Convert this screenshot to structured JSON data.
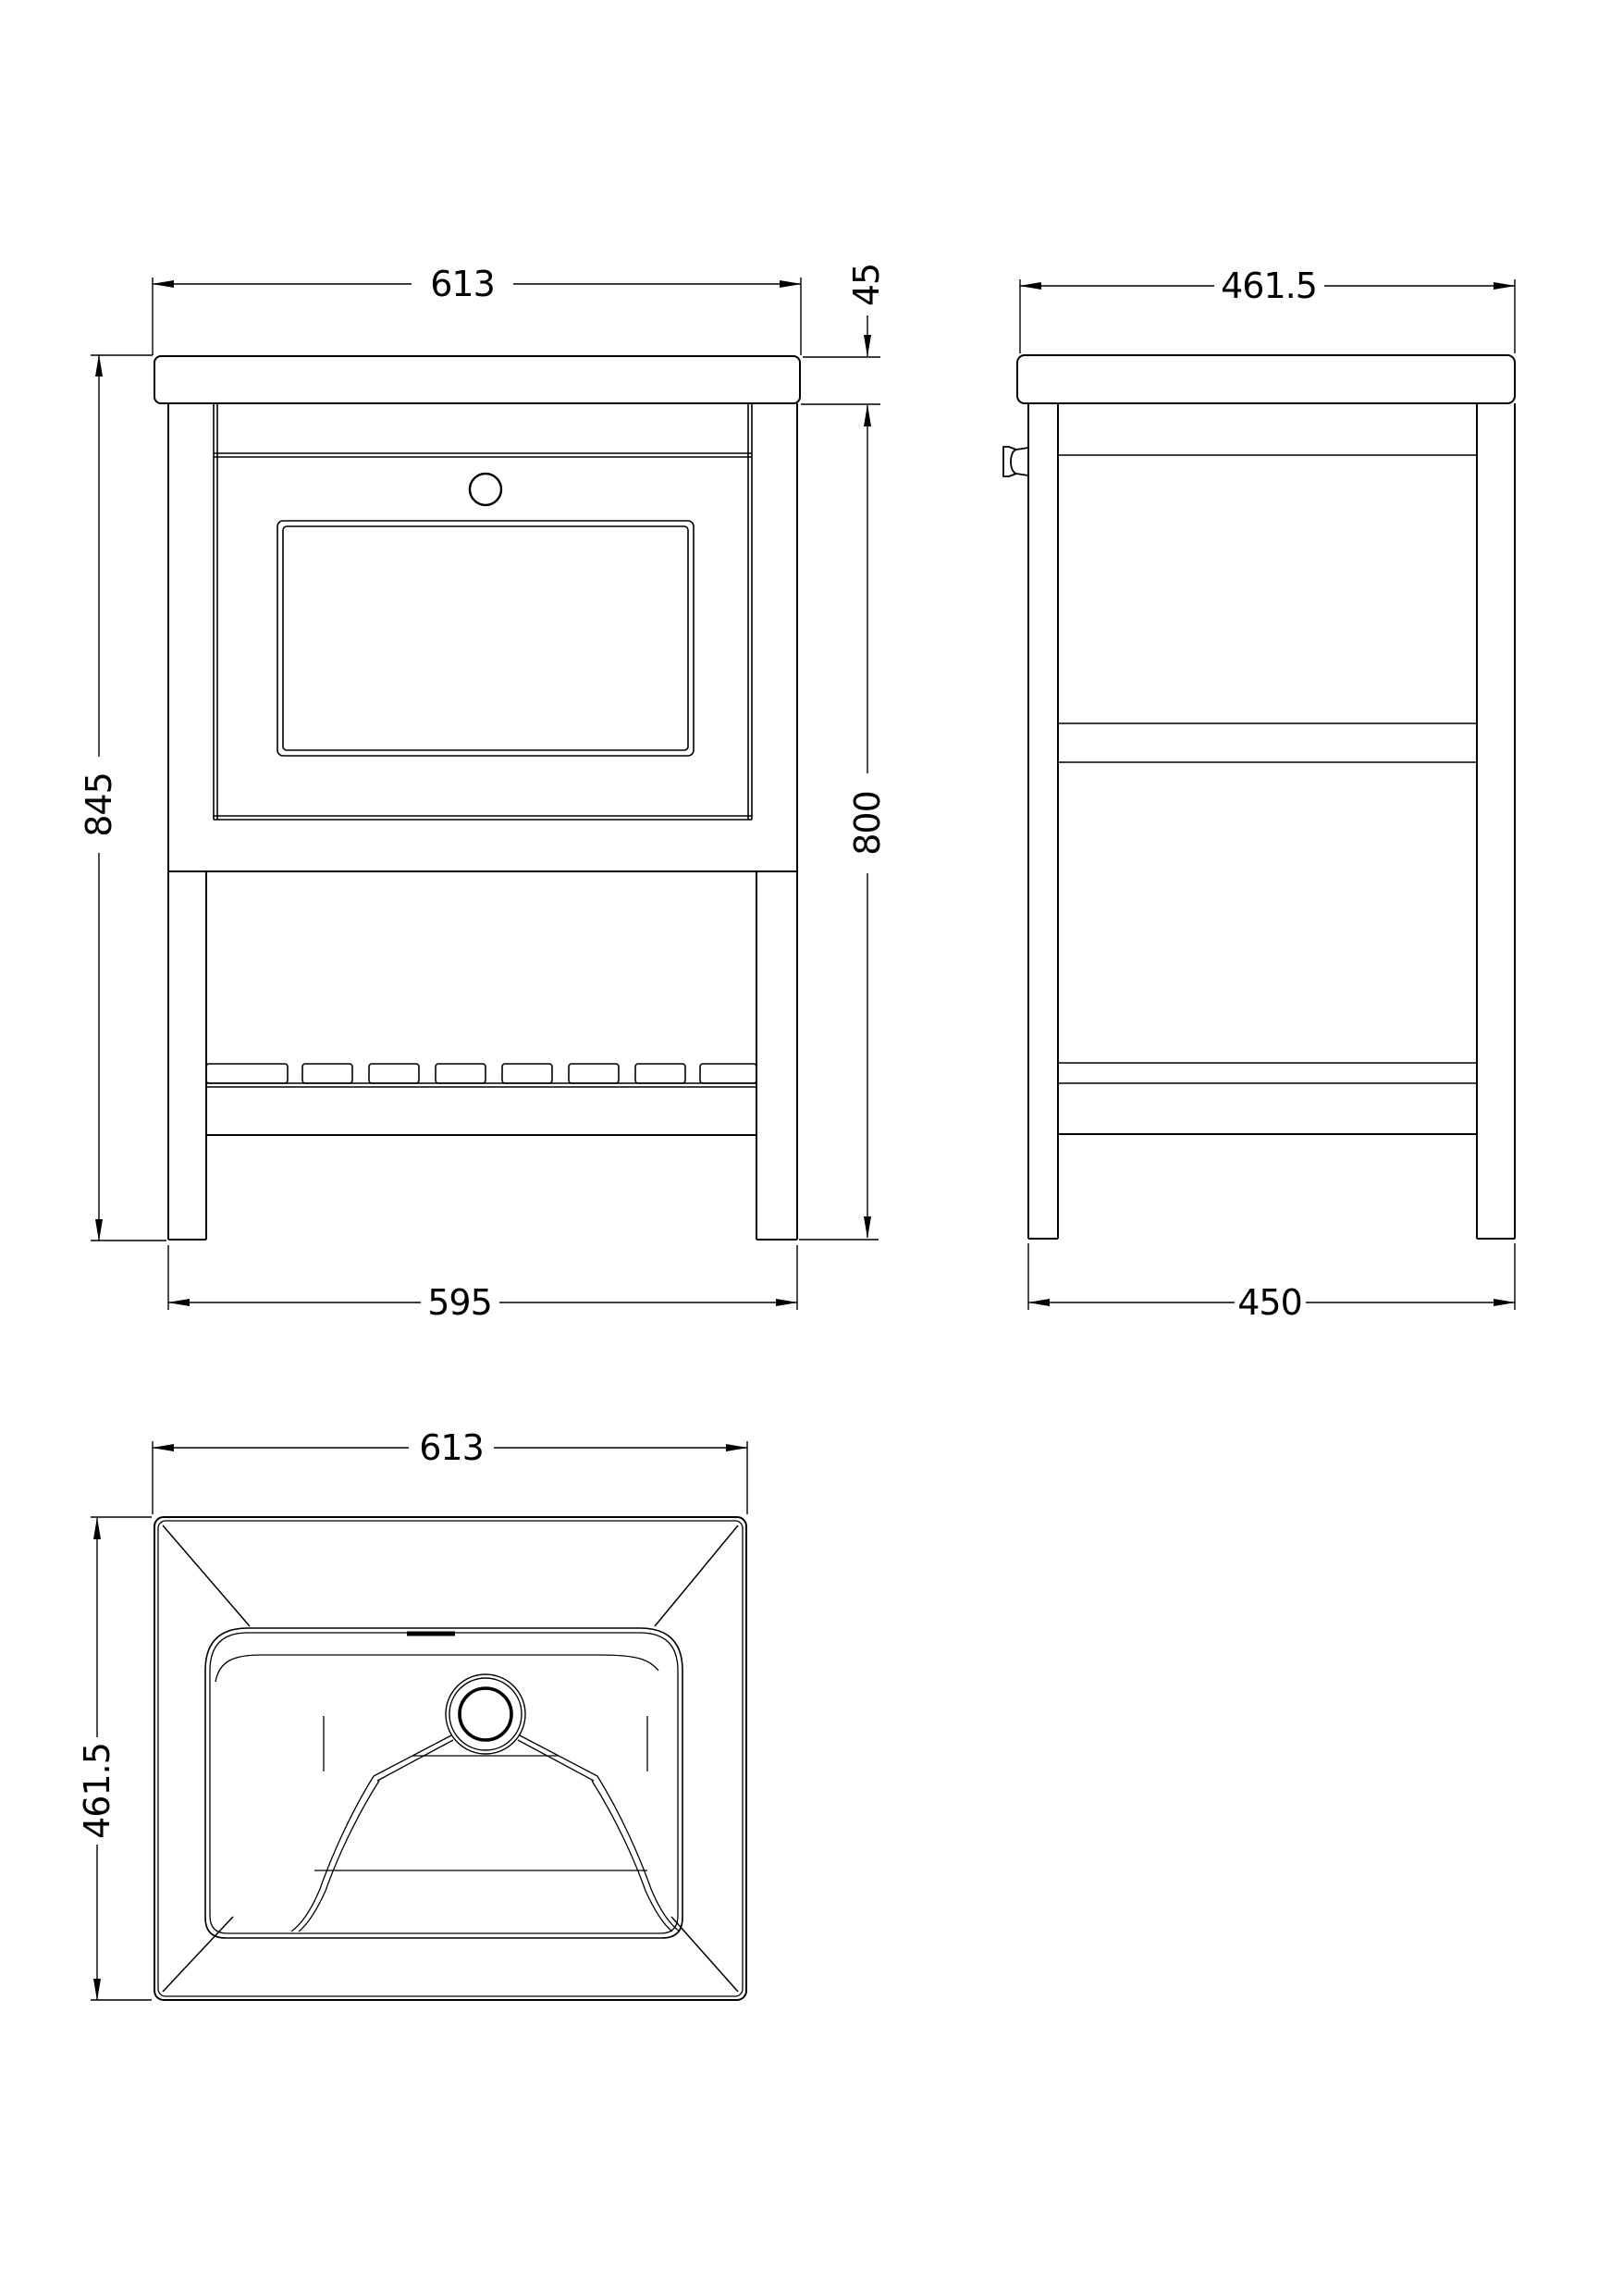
{
  "sheet": {
    "background": "#ffffff",
    "line_color": "#000000"
  },
  "dimensions": {
    "front": {
      "top_width": "613",
      "counter_thickness": "45",
      "overall_height": "845",
      "cabinet_height": "800",
      "base_width": "595"
    },
    "side": {
      "top_depth": "461.5",
      "base_depth": "450"
    },
    "plan": {
      "width": "613",
      "depth": "461.5"
    }
  }
}
